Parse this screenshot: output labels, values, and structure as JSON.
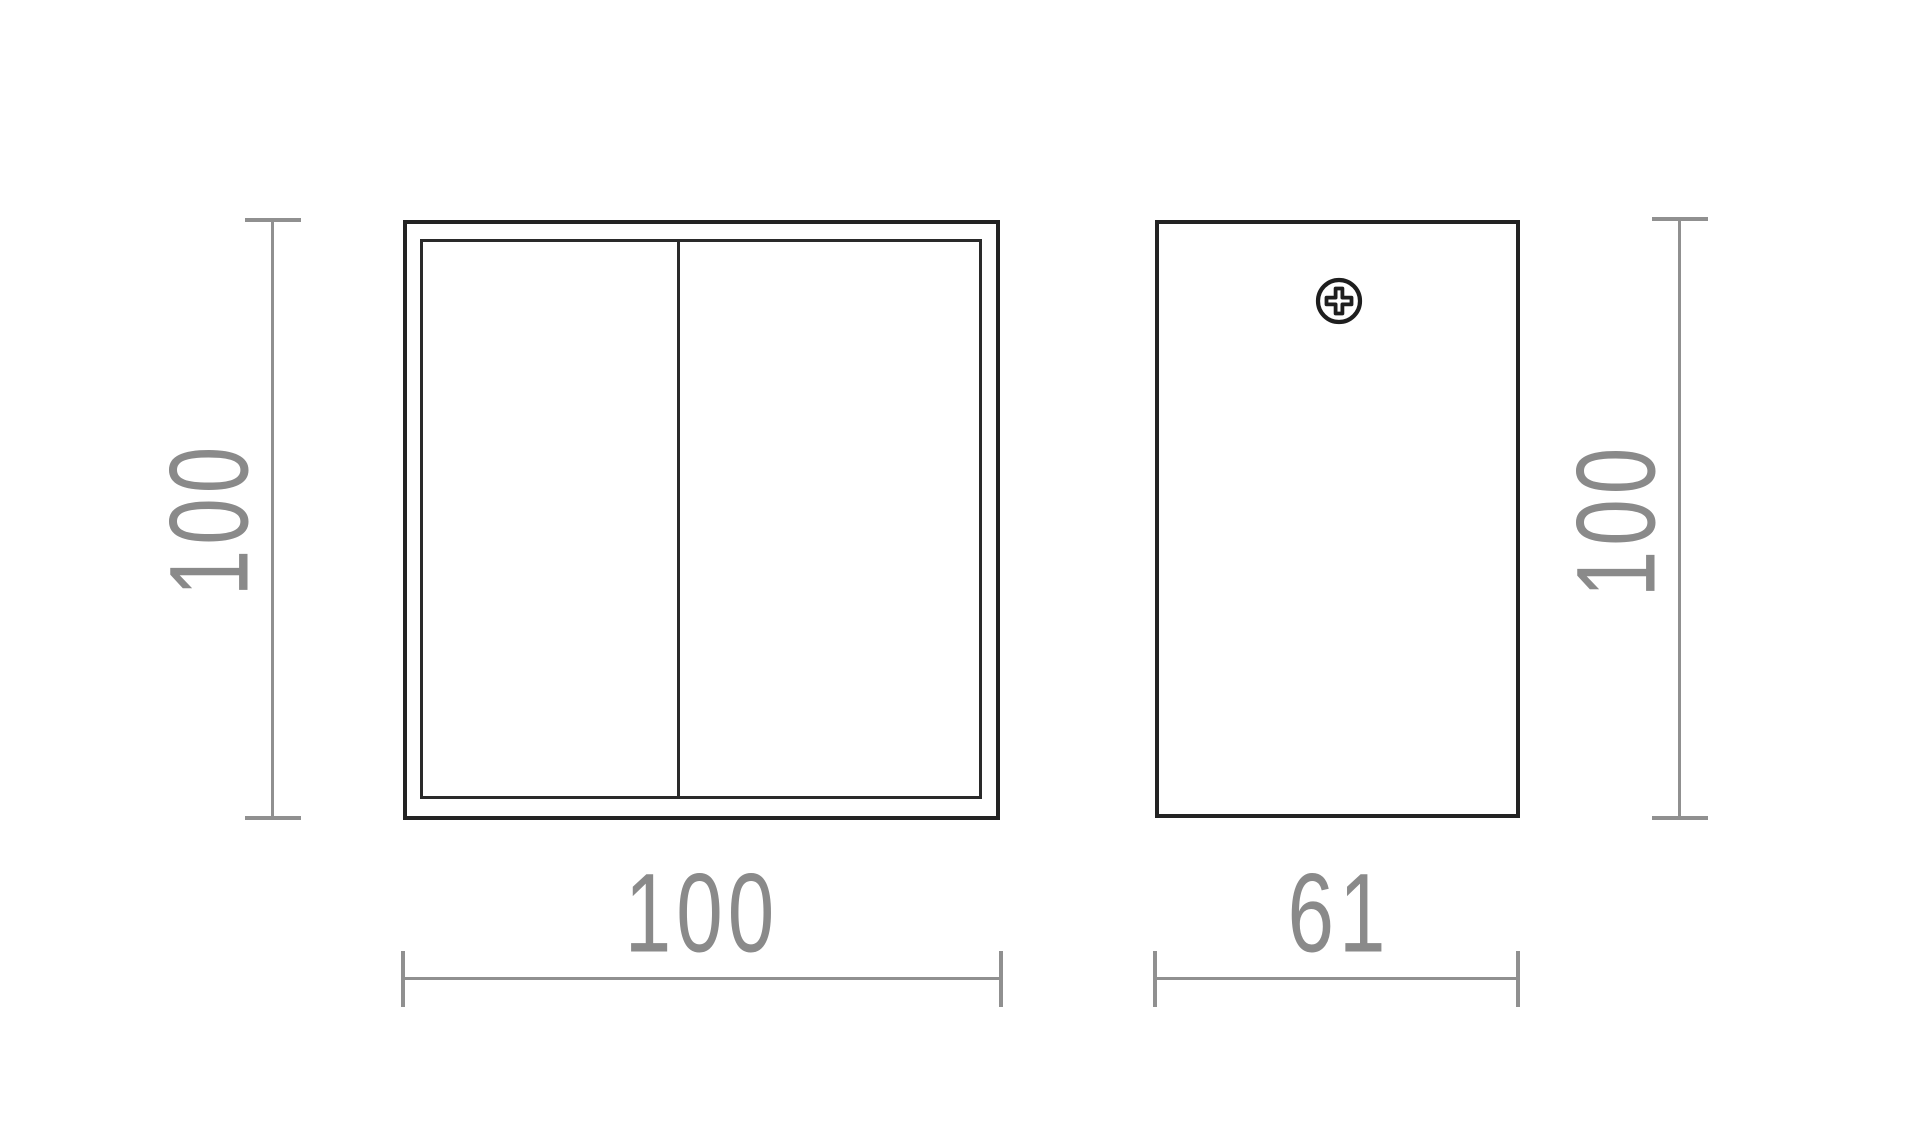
{
  "drawing": {
    "kind": "technical dimension drawing, two orthographic views",
    "colors": {
      "background": "#ffffff",
      "object_outline": "#232323",
      "dimension_gray": "#909090",
      "dimension_text": "#8a8a8a"
    },
    "views": {
      "front": {
        "label": "front-view",
        "width": "100",
        "height": "100"
      },
      "side": {
        "label": "side-view",
        "width": "61",
        "height": "100"
      }
    },
    "icons": {
      "screw": "phillips-screw"
    }
  }
}
